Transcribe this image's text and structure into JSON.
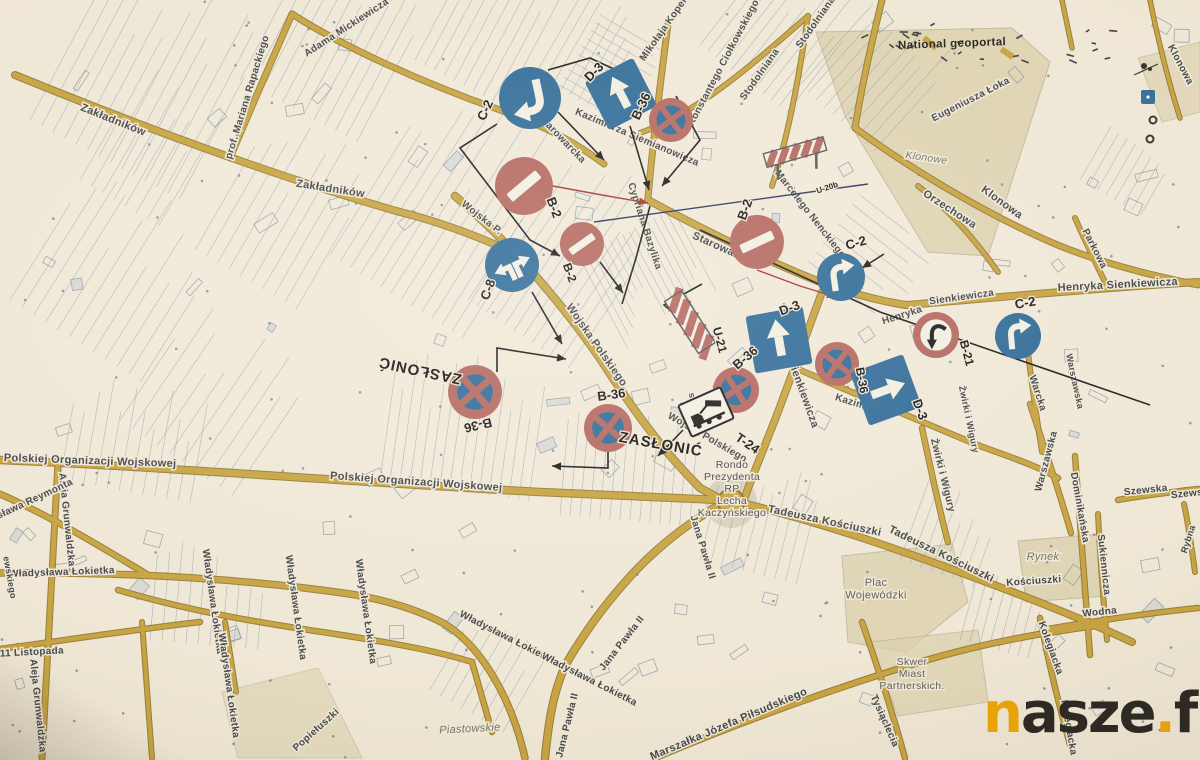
{
  "header": {
    "note": "National geoportal"
  },
  "watermark": {
    "n": "n",
    "asze": "asze",
    "dot": ".",
    "fm": "fm"
  },
  "colors": {
    "paper": "#f1e9d8",
    "road": "#c7a23d",
    "road_edge": "#8a7026",
    "parcel": "#8095a8",
    "sign_blue": "#2f6b98",
    "sign_red": "#b4675e",
    "sign_white": "#f3efe2",
    "sign_black": "#1b1b1b",
    "street_text": "#3e4347",
    "area_fill": "#dcd2ae",
    "navy_line": "#27355e",
    "red_line": "#a33530",
    "black_line": "#1a1a1a"
  },
  "signs": [
    {
      "id": "c2-1",
      "type": "C-2",
      "label": "C-2",
      "x": 530,
      "y": 98,
      "r": 31,
      "rot": 168,
      "lx": 489,
      "ly": 112,
      "lrot": -65,
      "lsize": 13
    },
    {
      "id": "d3-1",
      "type": "D-3",
      "label": "D-3",
      "x": 621,
      "y": 94,
      "r": 27,
      "rot": -27,
      "lx": 597,
      "ly": 75,
      "lrot": -45,
      "lsize": 13
    },
    {
      "id": "b36-1",
      "type": "B-36",
      "label": "B-36",
      "x": 671,
      "y": 120,
      "r": 22,
      "rot": 8,
      "lx": 645,
      "ly": 108,
      "lrot": -65,
      "lsize": 13
    },
    {
      "id": "b2-1",
      "type": "B-2",
      "label": "B-2",
      "x": 524,
      "y": 186,
      "r": 29,
      "rot": -40,
      "lx": 550,
      "ly": 209,
      "lrot": 70,
      "lsize": 13
    },
    {
      "id": "b2-2",
      "type": "B-2",
      "label": "B-2",
      "x": 582,
      "y": 244,
      "r": 22,
      "rot": -35,
      "lx": 566,
      "ly": 274,
      "lrot": 70,
      "lsize": 12
    },
    {
      "id": "c8-1",
      "type": "C-8",
      "label": "C-8",
      "x": 512,
      "y": 265,
      "r": 27,
      "rot": -25,
      "lx": 492,
      "ly": 291,
      "lrot": -70,
      "lsize": 13
    },
    {
      "id": "b2-3",
      "type": "B-2",
      "label": "B-2",
      "x": 757,
      "y": 242,
      "r": 27,
      "rot": -25,
      "lx": 749,
      "ly": 211,
      "lrot": -70,
      "lsize": 13
    },
    {
      "id": "c2-2",
      "type": "C-2",
      "label": "C-2",
      "x": 841,
      "y": 277,
      "r": 24,
      "rot": -8,
      "lx": 857,
      "ly": 247,
      "lrot": -15,
      "lsize": 13
    },
    {
      "id": "b21-1",
      "type": "B-21",
      "label": "B-21",
      "x": 936,
      "y": 335,
      "r": 23,
      "rot": 0,
      "lx": 963,
      "ly": 354,
      "lrot": 75,
      "lsize": 12
    },
    {
      "id": "c2-3",
      "type": "C-2",
      "label": "C-2",
      "x": 1018,
      "y": 336,
      "r": 23,
      "rot": -5,
      "lx": 1026,
      "ly": 307,
      "lrot": -10,
      "lsize": 13
    },
    {
      "id": "u21-1",
      "type": "U-21",
      "label": "U-21",
      "x": 690,
      "y": 322,
      "r": 30,
      "rot": -33,
      "lx": 716,
      "ly": 341,
      "lrot": 75,
      "lsize": 12
    },
    {
      "id": "d3-2",
      "type": "D-3",
      "label": "D-3",
      "x": 779,
      "y": 340,
      "r": 29,
      "rot": -10,
      "lx": 791,
      "ly": 312,
      "lrot": -20,
      "lsize": 13
    },
    {
      "id": "b36-2",
      "type": "B-36",
      "label": "B-36",
      "x": 736,
      "y": 390,
      "r": 23,
      "rot": 12,
      "lx": 748,
      "ly": 361,
      "lrot": -40,
      "lsize": 13
    },
    {
      "id": "b36-3",
      "type": "B-36",
      "label": "B-36",
      "x": 837,
      "y": 364,
      "r": 22,
      "rot": -8,
      "lx": 858,
      "ly": 381,
      "lrot": 80,
      "lsize": 12
    },
    {
      "id": "d3-3",
      "type": "D-3",
      "label": "D-3",
      "x": 886,
      "y": 390,
      "r": 28,
      "rot": 70,
      "lx": 916,
      "ly": 411,
      "lrot": 70,
      "lsize": 13
    },
    {
      "id": "t24-1",
      "type": "T-24",
      "label": "T-24",
      "x": 706,
      "y": 412,
      "r": 23,
      "rot": -24,
      "lx": 745,
      "ly": 447,
      "lrot": 35,
      "lsize": 13
    },
    {
      "id": "b36-4",
      "type": "B-36",
      "label": "B-36",
      "x": 475,
      "y": 392,
      "r": 27,
      "rot": 5,
      "lx": 477,
      "ly": 421,
      "lrot": 167,
      "lsize": 13
    },
    {
      "id": "b36-5",
      "type": "B-36",
      "label": "B-36",
      "x": 608,
      "y": 428,
      "r": 24,
      "rot": -6,
      "lx": 612,
      "ly": 399,
      "lrot": -8,
      "lsize": 13
    },
    {
      "id": "u20b-1",
      "type": "U-20b",
      "label": "U-20b",
      "x": 795,
      "y": 152,
      "r": 31,
      "rot": -16,
      "lx": 828,
      "ly": 190,
      "lrot": -18,
      "lsize": 8
    }
  ],
  "annotations": [
    {
      "text": "ZASŁONIĆ",
      "x": 421,
      "y": 366,
      "rot": 192,
      "size": 15
    },
    {
      "text": "ZASŁONIĆ",
      "x": 660,
      "y": 449,
      "rot": 10,
      "size": 15
    }
  ],
  "street_labels": [
    {
      "text": "Zakładników",
      "x": 112,
      "y": 123,
      "rot": 22,
      "size": 11
    },
    {
      "text": "Zakładników",
      "x": 330,
      "y": 192,
      "rot": 9,
      "size": 11
    },
    {
      "text": "prof. Mariana Rapackiego",
      "x": 250,
      "y": 98,
      "rot": -73,
      "size": 10
    },
    {
      "text": "Adama Mickiewicza",
      "x": 348,
      "y": 30,
      "rot": -33,
      "size": 10
    },
    {
      "text": "Mikołaja Kopernika",
      "x": 672,
      "y": 22,
      "rot": -55,
      "size": 10
    },
    {
      "text": "Konstantego Ciołkowskiego",
      "x": 726,
      "y": 64,
      "rot": -62,
      "size": 10
    },
    {
      "text": "Stodolniana",
      "x": 762,
      "y": 76,
      "rot": -55,
      "size": 10
    },
    {
      "text": "Stodolniana",
      "x": 818,
      "y": 24,
      "rot": -55,
      "size": 10
    },
    {
      "text": "Kazimierza Siemianowicza",
      "x": 636,
      "y": 140,
      "rot": 23,
      "size": 10
    },
    {
      "text": "Starowarcka",
      "x": 560,
      "y": 141,
      "rot": 46,
      "size": 10
    },
    {
      "text": "Starowarcka",
      "x": 723,
      "y": 252,
      "rot": 24,
      "size": 11
    },
    {
      "text": "Cypriana Bazylika",
      "x": 642,
      "y": 227,
      "rot": 72,
      "size": 10
    },
    {
      "text": "Marcelego Nenckiego",
      "x": 808,
      "y": 216,
      "rot": 52,
      "size": 10
    },
    {
      "text": "Orzechowa",
      "x": 948,
      "y": 212,
      "rot": 33,
      "size": 11
    },
    {
      "text": "Klonowa",
      "x": 1000,
      "y": 205,
      "rot": 36,
      "size": 11
    },
    {
      "text": "Klonowa",
      "x": 1178,
      "y": 66,
      "rot": 62,
      "size": 10
    },
    {
      "text": "Eugeniusza Łoka",
      "x": 972,
      "y": 102,
      "rot": -27,
      "size": 10
    },
    {
      "text": "Henryka Sienkiewicza",
      "x": 1118,
      "y": 288,
      "rot": -3,
      "size": 11
    },
    {
      "text": "Parkowa",
      "x": 1092,
      "y": 250,
      "rot": 63,
      "size": 10
    },
    {
      "text": "Sienkiewicza",
      "x": 962,
      "y": 300,
      "rot": -8,
      "size": 10
    },
    {
      "text": "Henryka",
      "x": 903,
      "y": 318,
      "rot": -18,
      "size": 10
    },
    {
      "text": "Henryka Sienkiewicza",
      "x": 792,
      "y": 372,
      "rot": 70,
      "size": 11
    },
    {
      "text": "Kazimierza",
      "x": 861,
      "y": 408,
      "rot": 17,
      "size": 10
    },
    {
      "text": "Żwirki i Wigury",
      "x": 940,
      "y": 476,
      "rot": 76,
      "size": 10
    },
    {
      "text": "Żwirki i Wigury",
      "x": 966,
      "y": 420,
      "rot": 78,
      "size": 9
    },
    {
      "text": "Warcka",
      "x": 1035,
      "y": 394,
      "rot": 72,
      "size": 10
    },
    {
      "text": "Warszawska",
      "x": 1049,
      "y": 462,
      "rot": -75,
      "size": 10
    },
    {
      "text": "Warszawska",
      "x": 1072,
      "y": 382,
      "rot": 78,
      "size": 9
    },
    {
      "text": "Dominikańska",
      "x": 1077,
      "y": 508,
      "rot": 80,
      "size": 10
    },
    {
      "text": "Sukiennicza",
      "x": 1101,
      "y": 565,
      "rot": 84,
      "size": 10
    },
    {
      "text": "Szewska",
      "x": 1146,
      "y": 493,
      "rot": -6,
      "size": 10
    },
    {
      "text": "Szewska",
      "x": 1193,
      "y": 496,
      "rot": -6,
      "size": 10
    },
    {
      "text": "Rybna",
      "x": 1191,
      "y": 540,
      "rot": -72,
      "size": 9
    },
    {
      "text": "Wodna",
      "x": 1100,
      "y": 615,
      "rot": -6,
      "size": 10
    },
    {
      "text": "Kolegiacka",
      "x": 1048,
      "y": 649,
      "rot": 70,
      "size": 10
    },
    {
      "text": "Kolegiacka",
      "x": 1066,
      "y": 728,
      "rot": 80,
      "size": 10
    },
    {
      "text": "Tysiąclecia",
      "x": 882,
      "y": 722,
      "rot": 66,
      "size": 10
    },
    {
      "text": "Tadeusza Kościuszki",
      "x": 824,
      "y": 524,
      "rot": 12,
      "size": 11
    },
    {
      "text": "Tadeusza Kościuszki",
      "x": 940,
      "y": 557,
      "rot": 26,
      "size": 11
    },
    {
      "text": "Kościuszki",
      "x": 1034,
      "y": 584,
      "rot": -4,
      "size": 10
    },
    {
      "text": "Jana Pawła II",
      "x": 700,
      "y": 548,
      "rot": 73,
      "size": 10
    },
    {
      "text": "Jana Pawła II",
      "x": 624,
      "y": 645,
      "rot": -52,
      "size": 10
    },
    {
      "text": "Jana Pawła II",
      "x": 570,
      "y": 726,
      "rot": -76,
      "size": 10
    },
    {
      "text": "Marszałka Józefa Piłsudskiego",
      "x": 730,
      "y": 727,
      "rot": -23,
      "size": 11
    },
    {
      "text": "Władysława Łokietka",
      "x": 506,
      "y": 640,
      "rot": 27,
      "size": 10
    },
    {
      "text": "Władysława Łokietka",
      "x": 588,
      "y": 682,
      "rot": 27,
      "size": 10
    },
    {
      "text": "Polskiej Organizacji Wojskowej",
      "x": 90,
      "y": 464,
      "rot": 2,
      "size": 11
    },
    {
      "text": "Polskiej Organizacji Wojskowej",
      "x": 416,
      "y": 485,
      "rot": 4,
      "size": 11
    },
    {
      "text": "Władysława Łokietka",
      "x": 62,
      "y": 575,
      "rot": -2,
      "size": 10
    },
    {
      "text": "Władysława Łokietka",
      "x": 210,
      "y": 602,
      "rot": 82,
      "size": 10
    },
    {
      "text": "Władysława Łokietka",
      "x": 293,
      "y": 608,
      "rot": 82,
      "size": 10
    },
    {
      "text": "Władysława Łokietka",
      "x": 363,
      "y": 612,
      "rot": 82,
      "size": 10
    },
    {
      "text": "Władysława Łokietka",
      "x": 226,
      "y": 686,
      "rot": 82,
      "size": 10
    },
    {
      "text": "Popiełuszki",
      "x": 318,
      "y": 732,
      "rot": -42,
      "size": 10
    },
    {
      "text": "11 Listopada",
      "x": 32,
      "y": 655,
      "rot": -3,
      "size": 10
    },
    {
      "text": "Aleja Grunwaldzka",
      "x": 64,
      "y": 520,
      "rot": 84,
      "size": 10
    },
    {
      "text": "Aleja Grunwaldzka",
      "x": 35,
      "y": 706,
      "rot": 84,
      "size": 10
    },
    {
      "text": "Władysława Reymonta",
      "x": 22,
      "y": 508,
      "rot": -25,
      "size": 10
    },
    {
      "text": "ewskiego",
      "x": 7,
      "y": 578,
      "rot": 80,
      "size": 9
    },
    {
      "text": "Wojska P.",
      "x": 480,
      "y": 220,
      "rot": 38,
      "size": 10
    },
    {
      "text": "Wojska Polskiego",
      "x": 594,
      "y": 347,
      "rot": 55,
      "size": 11
    },
    {
      "text": "Wojska Polskiego",
      "x": 706,
      "y": 440,
      "rot": 30,
      "size": 10
    },
    {
      "text": "stanowa",
      "x": 692,
      "y": 412,
      "rot": 80,
      "size": 9
    }
  ],
  "area_labels": [
    {
      "lines": [
        "Klonowe"
      ],
      "x": 926,
      "y": 161,
      "rot": 8,
      "size": 10.5,
      "color": "#6f7264",
      "italic": true
    },
    {
      "lines": [
        "Rynek"
      ],
      "x": 1043,
      "y": 560,
      "rot": 0,
      "size": 11,
      "color": "#6f7264",
      "italic": true
    },
    {
      "lines": [
        "Piastowskie"
      ],
      "x": 470,
      "y": 732,
      "rot": -3,
      "size": 11,
      "color": "#6f7264",
      "italic": true
    },
    {
      "lines": [
        "Plac",
        "Wojewódzki"
      ],
      "x": 876,
      "y": 586,
      "rot": 0,
      "size": 11,
      "color": "#585c55",
      "italic": false
    },
    {
      "lines": [
        "Skwer",
        "Miast",
        "Partnerskich."
      ],
      "x": 912,
      "y": 665,
      "rot": 0,
      "size": 10.5,
      "color": "#585c55",
      "italic": false
    },
    {
      "lines": [
        "Rondo",
        "Prezydenta",
        "RP",
        "Lecha",
        "Kaczyńskiego"
      ],
      "x": 732,
      "y": 468,
      "rot": 0,
      "size": 10.5,
      "color": "#41464b",
      "italic": false
    }
  ],
  "leader_lines": [
    {
      "pts": [
        [
          558,
          112
        ],
        [
          604,
          160
        ]
      ],
      "color": "black",
      "arrow": true
    },
    {
      "pts": [
        [
          630,
          126
        ],
        [
          649,
          190
        ]
      ],
      "color": "black",
      "arrow": true
    },
    {
      "pts": [
        [
          497,
          124
        ],
        [
          460,
          148
        ],
        [
          530,
          240
        ],
        [
          560,
          256
        ]
      ],
      "color": "black",
      "arrow": true
    },
    {
      "pts": [
        [
          532,
          292
        ],
        [
          562,
          344
        ]
      ],
      "color": "black",
      "arrow": true
    },
    {
      "pts": [
        [
          600,
          262
        ],
        [
          623,
          293
        ]
      ],
      "color": "black",
      "arrow": true
    },
    {
      "pts": [
        [
          676,
          96
        ],
        [
          700,
          140
        ],
        [
          662,
          186
        ]
      ],
      "color": "black",
      "arrow": true
    },
    {
      "pts": [
        [
          702,
          284
        ],
        [
          664,
          305
        ],
        [
          700,
          335
        ]
      ],
      "color": "black",
      "arrow": false
    },
    {
      "pts": [
        [
          683,
          430
        ],
        [
          658,
          456
        ]
      ],
      "color": "black",
      "arrow": true
    },
    {
      "pts": [
        [
          497,
          372
        ],
        [
          497,
          348
        ],
        [
          566,
          359
        ]
      ],
      "color": "black",
      "arrow": true
    },
    {
      "pts": [
        [
          608,
          452
        ],
        [
          608,
          468
        ],
        [
          552,
          466
        ]
      ],
      "color": "black",
      "arrow": true
    },
    {
      "pts": [
        [
          700,
          230
        ],
        [
          880,
          312
        ],
        [
          1150,
          405
        ]
      ],
      "color": "black",
      "arrow": false
    },
    {
      "pts": [
        [
          884,
          254
        ],
        [
          862,
          268
        ]
      ],
      "color": "black",
      "arrow": true
    },
    {
      "pts": [
        [
          757,
          270
        ],
        [
          800,
          286
        ],
        [
          836,
          297
        ]
      ],
      "color": "red",
      "arrow": true
    },
    {
      "pts": [
        [
          520,
          180
        ],
        [
          602,
          195
        ],
        [
          648,
          203
        ]
      ],
      "color": "red",
      "arrow": true
    },
    {
      "pts": [
        [
          594,
          222
        ],
        [
          868,
          184
        ]
      ],
      "color": "navy",
      "arrow": false
    },
    {
      "pts": [
        [
          650,
          206
        ],
        [
          636,
          258
        ],
        [
          622,
          304
        ]
      ],
      "color": "black",
      "arrow": false
    },
    {
      "pts": [
        [
          548,
          70
        ],
        [
          590,
          58
        ],
        [
          616,
          70
        ]
      ],
      "color": "black",
      "arrow": false
    }
  ],
  "map_markers": [
    {
      "type": "gear",
      "x": 1144,
      "y": 66
    },
    {
      "type": "blue-square",
      "x": 1148,
      "y": 97
    },
    {
      "type": "ring",
      "x": 1153,
      "y": 120
    },
    {
      "type": "ring",
      "x": 1150,
      "y": 139
    }
  ]
}
